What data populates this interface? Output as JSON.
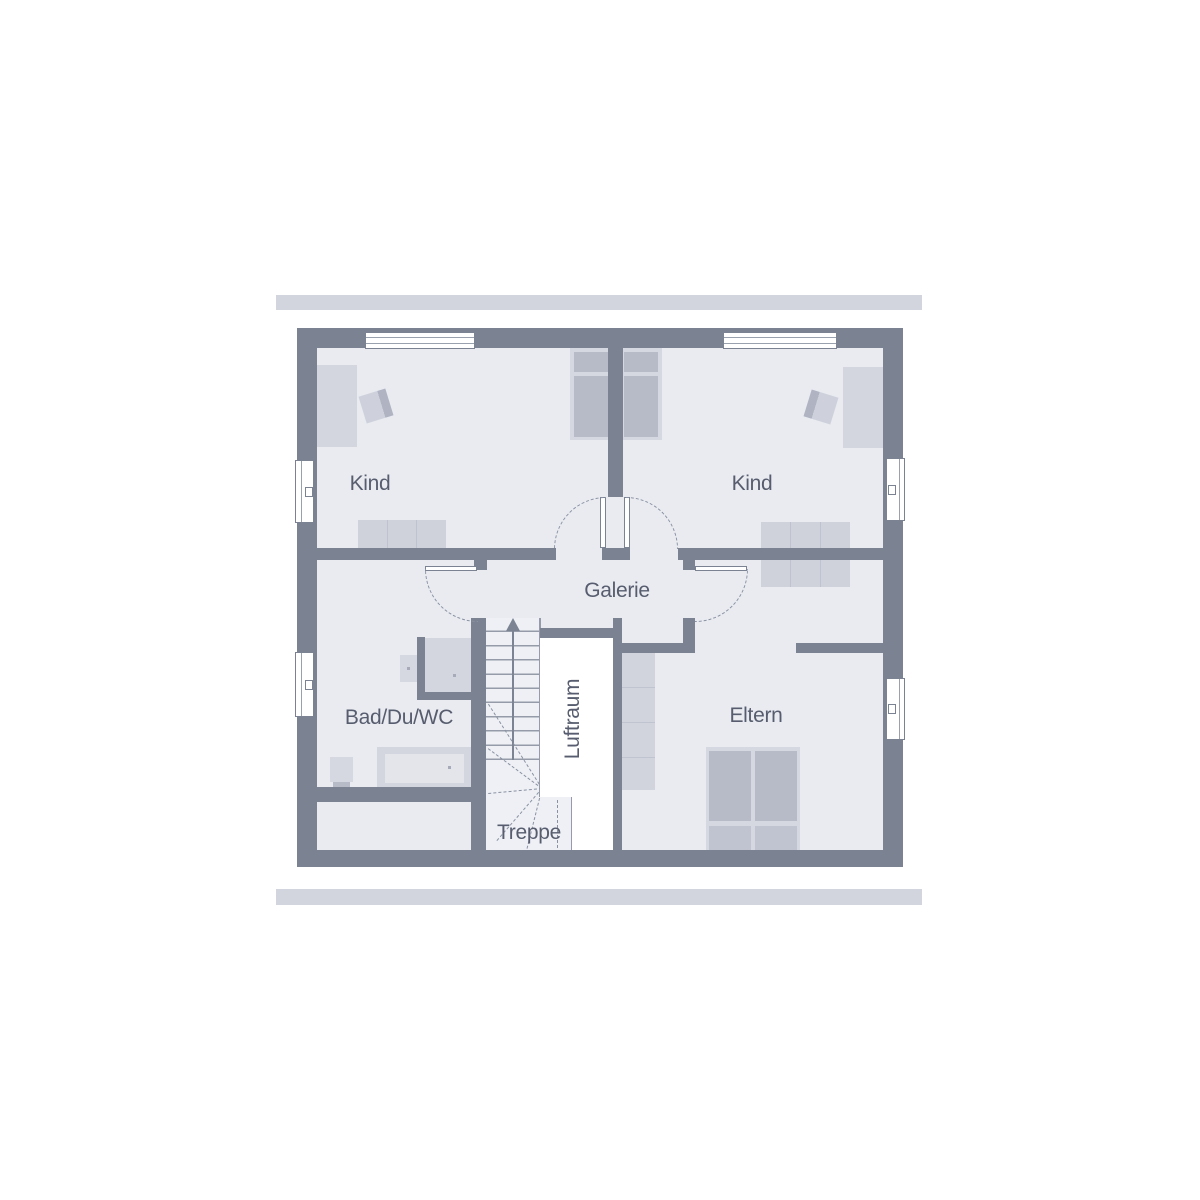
{
  "page": {
    "background": "#ffffff"
  },
  "plan": {
    "type": "floor-plan-upper-storey",
    "rooms": {
      "kind_left": "Kind",
      "kind_right": "Kind",
      "galerie": "Galerie",
      "bad_du_wc": "Bad/Du/WC",
      "eltern": "Eltern",
      "luftraum": "Luftraum",
      "treppe": "Treppe"
    },
    "colors": {
      "wall": "#7b8392",
      "floor": "#e9ebf1",
      "accent_bar": "#d3d5de",
      "furniture_light": "#d6d8e1",
      "furniture_medium": "#b7bbc8",
      "void_white": "#ffffff",
      "label_text": "#575d6e"
    },
    "icons": [
      "stair-direction-arrow"
    ]
  }
}
